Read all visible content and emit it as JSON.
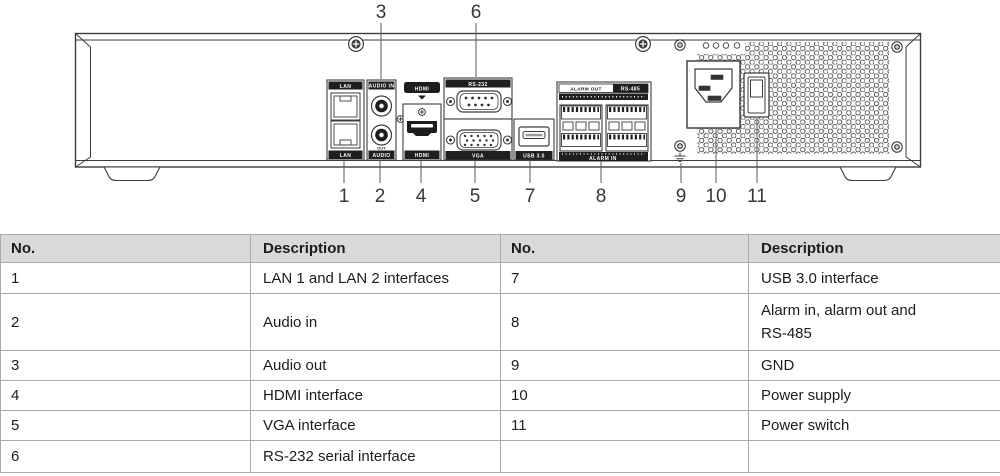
{
  "diagram": {
    "callouts_top": [
      {
        "label": "3"
      },
      {
        "label": "6"
      }
    ],
    "callouts_bottom": [
      {
        "label": "1"
      },
      {
        "label": "2"
      },
      {
        "label": "4"
      },
      {
        "label": "5"
      },
      {
        "label": "7"
      },
      {
        "label": "8"
      },
      {
        "label": "9"
      },
      {
        "label": "10"
      },
      {
        "label": "11"
      }
    ],
    "labels": {
      "lan_top": "LAN",
      "lan_bottom": "LAN",
      "audio_top": "AUDIO IN",
      "audio_out_mark": "OUT",
      "audio_bottom": "AUDIO",
      "hdmi_logo": "HDMI",
      "hdmi_bottom": "HDMI",
      "rs232_top": "RS-232",
      "vga_bottom": "VGA",
      "usb_bottom": "USB 3.0",
      "alarm_out": "ALARM OUT",
      "rs485": "RS-485",
      "alarm_in": "ALARM IN"
    }
  },
  "table": {
    "headers": [
      "No.",
      "Description",
      "No.",
      "Description"
    ],
    "rows": [
      {
        "no_left": "1",
        "desc_left": "LAN 1 and LAN 2 interfaces",
        "no_right": "7",
        "desc_right": "USB 3.0 interface"
      },
      {
        "no_left": "2",
        "desc_left": "Audio in",
        "no_right": "8",
        "desc_right": "Alarm in, alarm out and",
        "desc_right2": "RS-485"
      },
      {
        "no_left": "3",
        "desc_left": "Audio out",
        "no_right": "9",
        "desc_right": "GND"
      },
      {
        "no_left": "4",
        "desc_left": "HDMI interface",
        "no_right": "10",
        "desc_right": "Power supply"
      },
      {
        "no_left": "5",
        "desc_left": "VGA interface",
        "no_right": "11",
        "desc_right": "Power switch"
      },
      {
        "no_left": "6",
        "desc_left": "RS-232 serial interface",
        "no_right": "",
        "desc_right": ""
      }
    ]
  },
  "colors": {
    "line": "#3c3c3c",
    "label_bar": "#1f1f1f",
    "table_header_bg": "#d9d9d9",
    "table_border": "#ababab",
    "text": "#1c1c1c"
  }
}
